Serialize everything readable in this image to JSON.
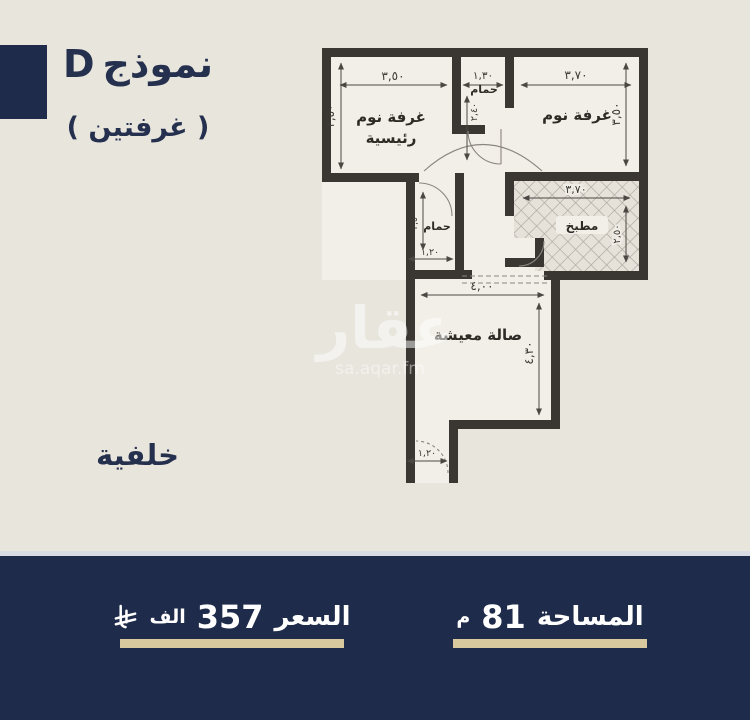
{
  "colors": {
    "background": "#e8e5dd",
    "navy": "#1f2b4b",
    "wall": "#3a3632",
    "beige_underline": "#d9c99e",
    "room_fill": "#f2efe8"
  },
  "header": {
    "model_word": "نموذج",
    "model_letter": "D",
    "subtitle": "( غرفتين )"
  },
  "side_label": "خلفية",
  "watermark": {
    "brand": "عقار",
    "site": "sa.aqar.fm"
  },
  "plan": {
    "rooms": {
      "master_bedroom": {
        "line1": "غرفة نوم",
        "line2": "رئيسية",
        "width": "٣,٥٠",
        "height": "٣,٥٠"
      },
      "bathroom_top": {
        "label": "حمام",
        "width": "١,٣٠",
        "height": "٢,٤٠"
      },
      "bedroom": {
        "label": "غرفة نوم",
        "width": "٣,٧٠",
        "height": "٣,٥٠"
      },
      "kitchen": {
        "label": "مطبخ",
        "width": "٣,٧٠",
        "height": "٢,٥٠"
      },
      "bathroom_mid": {
        "label": "حمام",
        "width": "١,٢٠",
        "height": "٢,٥٠"
      },
      "living": {
        "label": "صالة معيشة",
        "width": "٤,٠٠",
        "height": "٤,٣٠"
      },
      "entrance": {
        "width": "١,٢٠"
      }
    }
  },
  "footer": {
    "price": {
      "label": "السعر",
      "value": "357",
      "unit": "الف",
      "currency_icon": "saudi-riyal-icon"
    },
    "area": {
      "label": "المساحة",
      "value": "81",
      "unit": "م"
    }
  }
}
